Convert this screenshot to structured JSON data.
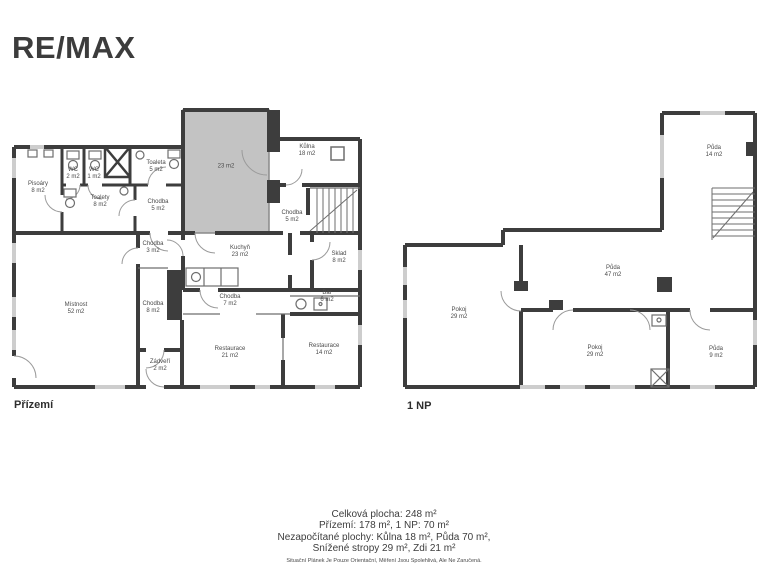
{
  "logo": {
    "text": "RE/MAX"
  },
  "colors": {
    "wall": "#3d3d3d",
    "gray_area": "#c3c3c3",
    "window": "#cdcdcd",
    "thin_line": "#6e6e6e",
    "door_arc": "#9a9a9a",
    "text": "#3f3f3f"
  },
  "plans": {
    "ground": {
      "label": "Přízemí",
      "rooms": [
        {
          "name": "Pisoáry",
          "area": "8 m2"
        },
        {
          "name": "WC",
          "area": "2 m2"
        },
        {
          "name": "WC",
          "area": "1 m2"
        },
        {
          "name": "Toaleta",
          "area": "5 m2"
        },
        {
          "name": "Toalety",
          "area": "8 m2"
        },
        {
          "name": "Chodba",
          "area": "5 m2"
        },
        {
          "name": "",
          "area": "23 m2"
        },
        {
          "name": "Kůlna",
          "area": "18 m2"
        },
        {
          "name": "Chodba",
          "area": "5 m2"
        },
        {
          "name": "Kuchyň",
          "area": "23 m2"
        },
        {
          "name": "Chodba",
          "area": "3 m2"
        },
        {
          "name": "Sklad",
          "area": "8 m2"
        },
        {
          "name": "Bar",
          "area": "6 m2"
        },
        {
          "name": "Chodba",
          "area": "7 m2"
        },
        {
          "name": "Místnost",
          "area": "52 m2"
        },
        {
          "name": "Chodba",
          "area": "8 m2"
        },
        {
          "name": "Restaurace",
          "area": "21 m2"
        },
        {
          "name": "Restaurace",
          "area": "14 m2"
        },
        {
          "name": "Zádveří",
          "area": "2 m2"
        }
      ]
    },
    "upper": {
      "label": "1 NP",
      "rooms": [
        {
          "name": "Půda",
          "area": "14 m2"
        },
        {
          "name": "Půda",
          "area": "47 m2"
        },
        {
          "name": "Pokoj",
          "area": "29 m2"
        },
        {
          "name": "Pokoj",
          "area": "29 m2"
        },
        {
          "name": "Půda",
          "area": "9 m2"
        }
      ]
    }
  },
  "summary": {
    "line1": "Celková plocha: 248 m²",
    "line2": "Přízemí: 178 m², 1 NP: 70 m²",
    "line3": "Nezapočítané plochy: Kůlna 18 m², Půda 70 m²,",
    "line4": "Snížené stropy 29 m², Zdi 21 m²",
    "disclaimer": "Situační Plánek Je Pouze Orientační, Měření Jsou Spolehlivá, Ale Ne Zaručená."
  }
}
